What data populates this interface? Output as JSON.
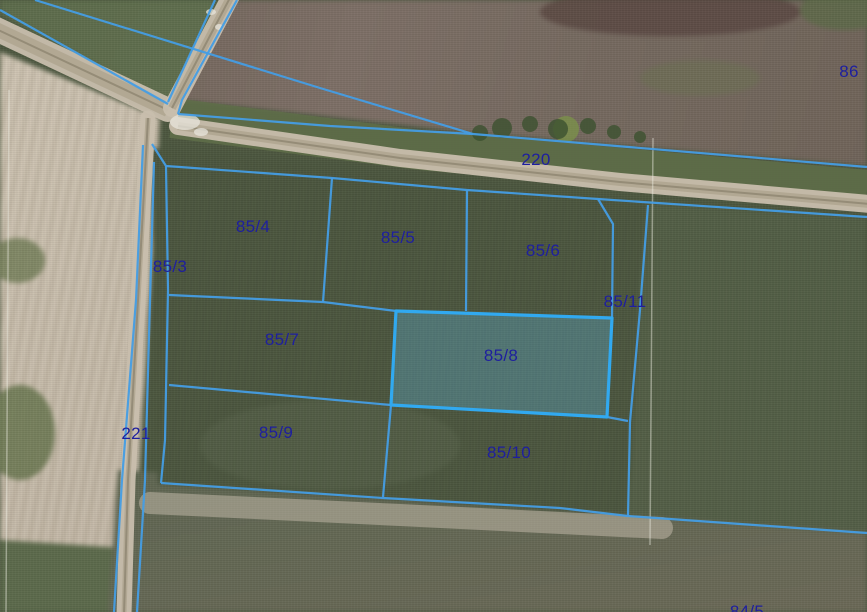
{
  "map": {
    "description": "cadastral-parcel-overlay-on-aerial-orthophoto",
    "selected_parcel": "85/8",
    "colors": {
      "boundary": "#449de4",
      "boundary_selected": "#31a9f0",
      "selected_fill_rgba": "rgba(96,188,232,0.30)",
      "label_text": "#1e1f9e"
    },
    "labels": [
      {
        "id": "86",
        "text": "86",
        "x": 849,
        "y": 72
      },
      {
        "id": "220",
        "text": "220",
        "x": 536,
        "y": 160
      },
      {
        "id": "85-4",
        "text": "85/4",
        "x": 253,
        "y": 227
      },
      {
        "id": "85-5",
        "text": "85/5",
        "x": 398,
        "y": 238
      },
      {
        "id": "85-6",
        "text": "85/6",
        "x": 543,
        "y": 251
      },
      {
        "id": "85-3",
        "text": "85/3",
        "x": 170,
        "y": 267
      },
      {
        "id": "85-11",
        "text": "85/11",
        "x": 625,
        "y": 302
      },
      {
        "id": "85-7",
        "text": "85/7",
        "x": 282,
        "y": 340
      },
      {
        "id": "85-8",
        "text": "85/8",
        "x": 501,
        "y": 356
      },
      {
        "id": "221",
        "text": "221",
        "x": 136,
        "y": 434
      },
      {
        "id": "85-9",
        "text": "85/9",
        "x": 276,
        "y": 433
      },
      {
        "id": "85-10",
        "text": "85/10",
        "x": 509,
        "y": 453
      },
      {
        "id": "84-5",
        "text": "84/5",
        "x": 747,
        "y": 612
      }
    ],
    "geometry": {
      "boundaries": [
        {
          "name": "nw-road-north",
          "points": [
            [
              0,
              10
            ],
            [
              168,
              104
            ]
          ]
        },
        {
          "name": "field-86-west",
          "points": [
            [
              35,
              0
            ],
            [
              320,
              88
            ],
            [
              473,
              134
            ]
          ]
        },
        {
          "name": "ne-road-west",
          "points": [
            [
              215,
              0
            ],
            [
              168,
              102
            ]
          ]
        },
        {
          "name": "ne-road-east",
          "points": [
            [
              237,
              0
            ],
            [
              182,
              100
            ],
            [
              178,
              114
            ]
          ]
        },
        {
          "name": "road-220-north",
          "points": [
            [
              178,
              114
            ],
            [
              330,
              126
            ],
            [
              473,
              134
            ],
            [
              867,
              167
            ]
          ]
        },
        {
          "name": "road-220-south-block-top",
          "points": [
            [
              152,
              144
            ],
            [
              166,
              166
            ],
            [
              332,
              178
            ],
            [
              467,
              190
            ],
            [
              598,
              199
            ],
            [
              867,
              217
            ]
          ]
        },
        {
          "name": "parcel-85-6-corner-cut",
          "points": [
            [
              598,
              199
            ],
            [
              613,
              224
            ],
            [
              612,
              318
            ]
          ]
        },
        {
          "name": "strip-85-11-east",
          "points": [
            [
              648,
              205
            ],
            [
              640,
              310
            ],
            [
              630,
              422
            ],
            [
              628,
              516
            ]
          ]
        },
        {
          "name": "block-left-edge",
          "points": [
            [
              166,
              166
            ],
            [
              168,
              290
            ],
            [
              165,
              440
            ],
            [
              161,
              483
            ]
          ]
        },
        {
          "name": "path-221-right",
          "points": [
            [
              154,
              162
            ],
            [
              150,
              300
            ],
            [
              145,
              480
            ],
            [
              137,
              612
            ]
          ]
        },
        {
          "name": "path-221-left",
          "points": [
            [
              143,
              145
            ],
            [
              136,
              300
            ],
            [
              122,
              480
            ],
            [
              114,
              612
            ]
          ]
        },
        {
          "name": "divider-85-4-85-5",
          "points": [
            [
              332,
              178
            ],
            [
              323,
              302
            ]
          ]
        },
        {
          "name": "divider-85-5-85-6",
          "points": [
            [
              467,
              190
            ],
            [
              466,
              311
            ]
          ]
        },
        {
          "name": "divider-85-4-85-7",
          "points": [
            [
              169,
              295
            ],
            [
              323,
              302
            ],
            [
              396,
              311
            ]
          ]
        },
        {
          "name": "divider-row-2-3-west",
          "points": [
            [
              169,
              385
            ],
            [
              391,
              405
            ]
          ]
        },
        {
          "name": "strip-85-11-south",
          "points": [
            [
              607,
              417
            ],
            [
              628,
              421
            ]
          ]
        },
        {
          "name": "divider-85-9-85-10",
          "points": [
            [
              391,
              405
            ],
            [
              383,
              497
            ]
          ]
        },
        {
          "name": "block-bottom",
          "points": [
            [
              161,
              483
            ],
            [
              383,
              498
            ],
            [
              560,
              508
            ],
            [
              628,
              516
            ],
            [
              867,
              533
            ]
          ]
        }
      ],
      "selected_polygon": [
        [
          396,
          311
        ],
        [
          612,
          318
        ],
        [
          607,
          417
        ],
        [
          391,
          405
        ]
      ],
      "roads": [
        {
          "name": "nw-dirt-road",
          "points": [
            [
              -6,
              28
            ],
            [
              168,
              110
            ]
          ],
          "width": 24
        },
        {
          "name": "ne-dirt-road",
          "points": [
            [
              232,
              -6
            ],
            [
              172,
              108
            ]
          ],
          "width": 18
        },
        {
          "name": "road-220-dirt",
          "points": [
            [
              178,
              126
            ],
            [
              400,
              158
            ],
            [
              620,
              182
            ],
            [
              870,
              204
            ]
          ],
          "width": 18
        },
        {
          "name": "path-221-dirt",
          "points": [
            [
              148,
              118
            ],
            [
              138,
              300
            ],
            [
              128,
              480
            ],
            [
              124,
              614
            ]
          ],
          "width": 15
        },
        {
          "name": "bottom-track",
          "points": [
            [
              150,
              503
            ],
            [
              400,
              515
            ],
            [
              662,
              528
            ]
          ],
          "width": 22
        }
      ],
      "scratch_lines": [
        {
          "name": "white-line-right",
          "points": [
            [
              653,
              138
            ],
            [
              650,
              545
            ]
          ]
        },
        {
          "name": "white-line-left",
          "points": [
            [
              9,
              90
            ],
            [
              6,
              612
            ]
          ]
        }
      ],
      "bushes": [
        [
          480,
          133,
          8
        ],
        [
          502,
          128,
          10
        ],
        [
          530,
          124,
          8
        ],
        [
          558,
          129,
          10
        ],
        [
          588,
          126,
          8
        ],
        [
          614,
          132,
          7
        ],
        [
          640,
          137,
          6
        ]
      ],
      "bright_bush": [
        566,
        129,
        13
      ],
      "white_patches": [
        [
          185,
          122,
          15,
          8
        ],
        [
          201,
          132,
          7,
          4
        ],
        [
          211,
          12,
          5,
          3
        ],
        [
          219,
          27,
          4,
          3
        ]
      ]
    }
  }
}
